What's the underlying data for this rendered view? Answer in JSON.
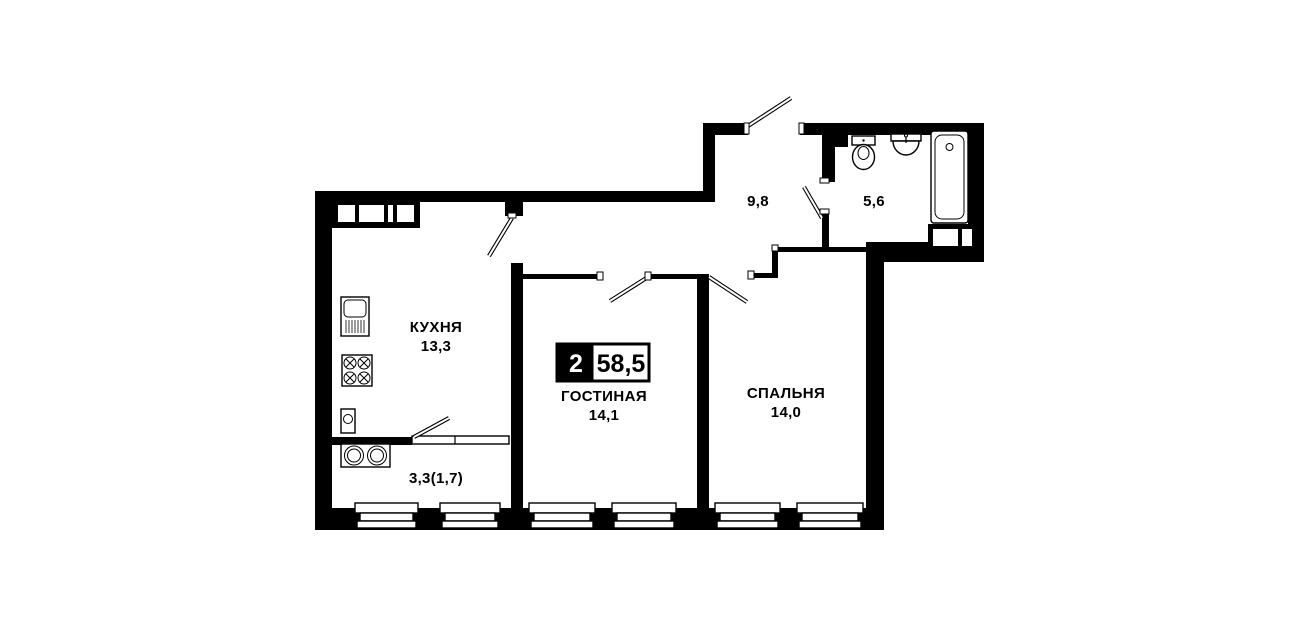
{
  "plan": {
    "badge": {
      "rooms_count": "2",
      "total_area": "58,5"
    },
    "rooms": {
      "kitchen": {
        "name": "КУХНЯ",
        "area": "13,3"
      },
      "living": {
        "name": "ГОСТИНАЯ",
        "area": "14,1"
      },
      "bedroom": {
        "name": "СПАЛЬНЯ",
        "area": "14,0"
      },
      "hallway": {
        "area": "9,8"
      },
      "bathroom": {
        "area": "5,6"
      },
      "balcony": {
        "area": "3,3(1,7)"
      }
    },
    "colors": {
      "wall": "#000000",
      "background": "#ffffff"
    }
  }
}
